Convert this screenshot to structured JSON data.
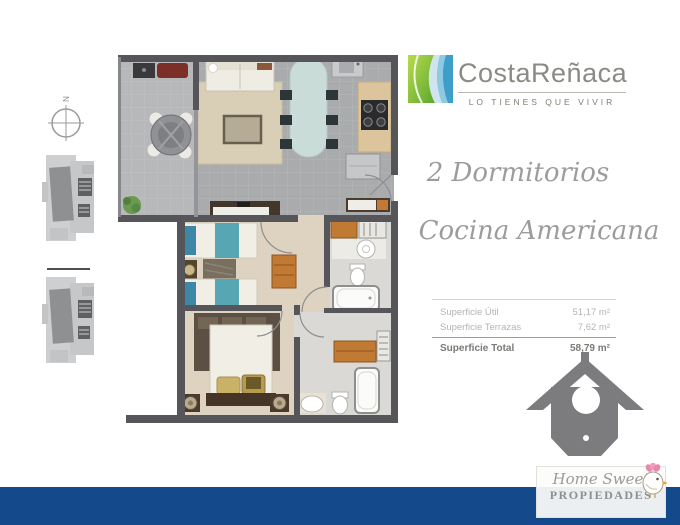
{
  "brand": {
    "name": "CostaReñaca",
    "tagline": "LO TIENES QUE VIVIR"
  },
  "compass": {
    "label": "N"
  },
  "features": {
    "bedrooms": "2 Dormitorios",
    "kitchen": "Cocina Americana"
  },
  "surface_table": {
    "rows": [
      {
        "label": "Superficie Útil",
        "value": "51,17 m²"
      },
      {
        "label": "Superficie Terrazas",
        "value": "7,62 m²"
      }
    ],
    "total": {
      "label": "Superficie Total",
      "value": "58,79 m²"
    }
  },
  "footer_logo": {
    "script": "Home Sweet",
    "caps": "PROPIEDADES"
  },
  "icons": {
    "compass": "north-crosshair-circle",
    "site_plan": "building-footprint-keyplan",
    "floor_plan": "2-bedroom-apartment-plan",
    "logo_mark": "green-blue-wave-square",
    "birdhouse": "gray-birdhouse",
    "bird": "pink-crested-bird"
  },
  "colors": {
    "brand_green": "#8cc63f",
    "brand_blue": "#3f9ec9",
    "bottom_bar": "#144a8c",
    "brand_text_gray": "#8b8b85",
    "script_gray": "#9c9c9c",
    "birdhouse_gray": "#7c7c7e",
    "wall_gray": "#56565a",
    "bedroom_floor": "#ded3c0",
    "terrace_floor": "#b6b8ba",
    "bed_teal": "#57a6b4",
    "closet_orange": "#c07a33"
  }
}
